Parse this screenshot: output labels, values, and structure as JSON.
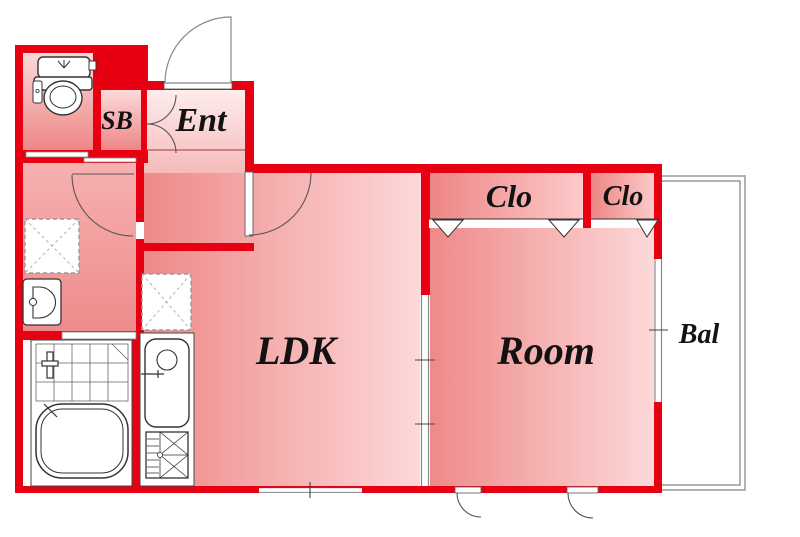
{
  "floorplan": {
    "labels": {
      "entrance": "Ent",
      "shoe_box": "SB",
      "living_dining_kitchen": "LDK",
      "bedroom": "Room",
      "closet_large": "Clo",
      "closet_small": "Clo",
      "balcony": "Bal"
    },
    "colors": {
      "wall_red": "#e60012",
      "room_pink_dark": "#ee8989",
      "room_pink_light": "#fdd9d9",
      "entrance_pink_light": "#feecec",
      "background": "#ffffff",
      "fixture_outline": "#333333",
      "label_text": "#121212",
      "balcony_line": "#999999"
    },
    "fixtures": [
      "toilet-icon",
      "washbasin-icon",
      "washing-machine-space",
      "refrigerator-space",
      "shower-tile-area",
      "bathtub-icon",
      "kitchen-sink-icon",
      "gas-stove-icon"
    ]
  }
}
